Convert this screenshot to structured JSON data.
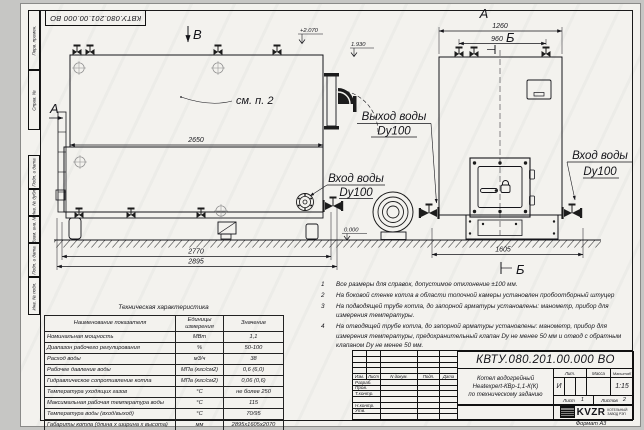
{
  "colors": {
    "paper": "#f3f2ee",
    "line": "#15151a",
    "background": "#c6c6c4"
  },
  "sheet": {
    "corner_stamp": "КВТУ.080.201.00.000 ВО",
    "format_label": "Формат  А3",
    "side_labels": {
      "perv_primen": "Перв. примен.",
      "sprav_no": "Справ. №",
      "podp_data_1": "Подп. и дата",
      "inv_dubl": "Инв. № дубл.",
      "vzam_inv": "Взам. инв. №",
      "podp_data_2": "Подп. и дата",
      "inv_podl": "Инв. № подл."
    }
  },
  "drawing": {
    "view_side": {
      "letter_b": "В",
      "letter_a": "А",
      "elev_top": "+2.070",
      "elev_outlet": "1.930",
      "elev_ground": "0.000",
      "note_ref": "см. п. 2",
      "dim_2650": "2650",
      "dim_2770": "2770",
      "dim_2895": "2895",
      "inlet_line1": "Вход воды",
      "inlet_line2": "Dy100",
      "outlet_line1": "Выход воды",
      "outlet_line2": "Dy100"
    },
    "view_front": {
      "letter_a": "А",
      "letter_b_top": "Б",
      "letter_b_bottom": "Б",
      "dim_1260": "1260",
      "dim_960": "960",
      "dim_1605": "1605",
      "inlet_line1": "Вход воды",
      "inlet_line2": "Dy100"
    }
  },
  "notes": {
    "items": [
      {
        "num": "1",
        "text": "Все размеры для справок, допустимое отклонение ±100 мм."
      },
      {
        "num": "2",
        "text": "На боковой стенке котла в области топочной камеры установлен пробоотборный штуцер"
      },
      {
        "num": "3",
        "text": "На подводящей трубе котла, до запорной арматуры установлены: манометр, прибор для измерения температуры."
      },
      {
        "num": "4",
        "text": "На отводящей трубе котла, до запорной арматуры установлены: манометр, прибор для измерения температуры, предохранительный клапан Dу не менее 50 мм и отвод с обратным клапаном Dу не менее 50 мм."
      }
    ]
  },
  "spec_table": {
    "title": "Техническая характеристика",
    "headers": [
      "Наименование показателя",
      "Единицы измерения",
      "Значение"
    ],
    "rows": [
      [
        "Номинальная мощность",
        "МВт",
        "1,1"
      ],
      [
        "Диапазон рабочего регулирования",
        "%",
        "50-100"
      ],
      [
        "Расход воды",
        "м3/ч",
        "38"
      ],
      [
        "Рабочее давление воды",
        "МПа (кгс/см2)",
        "0,6 (6,0)"
      ],
      [
        "Гидравлическое сопротивление котла",
        "МПа (кгс/см2)",
        "0,06 (0,6)"
      ],
      [
        "Температура уходящих газов",
        "°С",
        "не более 250"
      ],
      [
        "Максимальная рабочая температура воды",
        "°С",
        "115"
      ],
      [
        "Температура воды (вход/выход)",
        "°С",
        "70/95"
      ],
      [
        "Габариты котла (длина х ширина х высота)",
        "мм",
        "2895х1605х2070"
      ]
    ]
  },
  "title_block": {
    "doc_number": "КВТУ.080.201.00.000  ВО",
    "product_line1": "Котел водогрейный",
    "product_line2": "Heatexpert-КВр-1,1-К(К)",
    "product_line3": "по техническому заданию",
    "col_izm": "Изм.",
    "col_list": "Лист",
    "col_ndoc": "N докум.",
    "col_podp": "Подп.",
    "col_data": "Дата",
    "row_razrab": "Разраб.",
    "row_prov": "Пров.",
    "row_tkontr": "Т.контр.",
    "row_nkontr": "Н.контр.",
    "row_utv": "Утв.",
    "lit_header": "Лит.",
    "massa_header": "Масса",
    "masshtab_header": "Масштаб",
    "lit_value": "И",
    "masshtab_value": "1:15",
    "list_label": "Лист",
    "list_value": "1",
    "listov_label": "Листов",
    "listov_value": "2",
    "logo_text": "KVZR",
    "logo_sub1": "КОТЕЛЬНЫЙ",
    "logo_sub2": "ЗАВОД РЭП"
  }
}
